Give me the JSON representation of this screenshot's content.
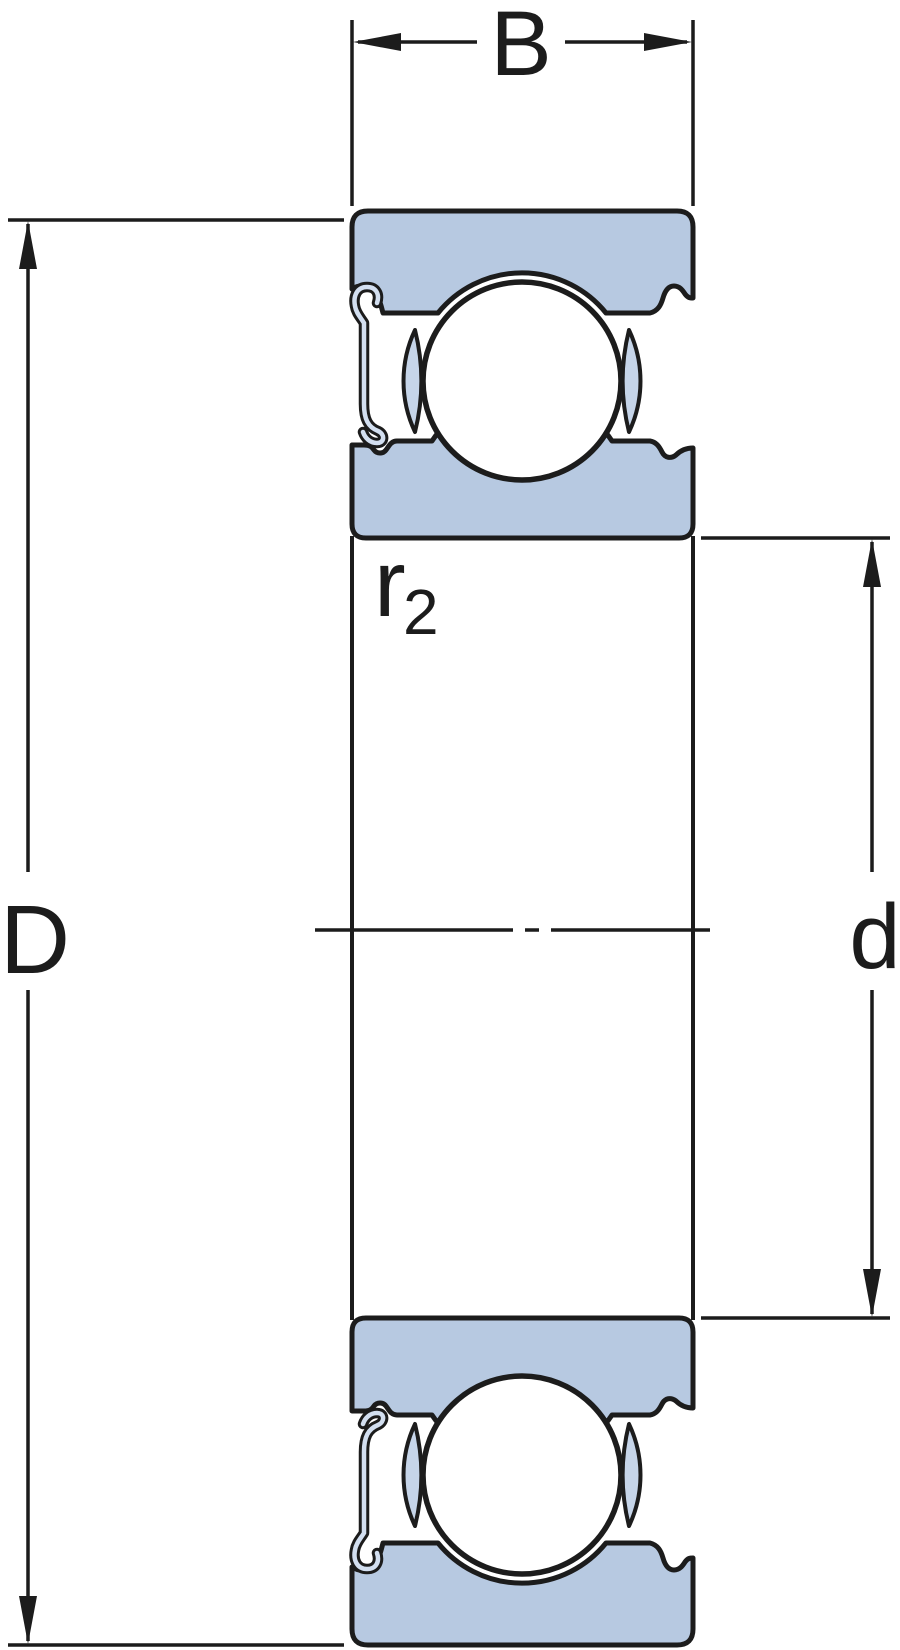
{
  "diagram": {
    "labels": {
      "width": "B",
      "outer_diameter": "D",
      "bore_diameter": "d",
      "fillet_radius": "r",
      "fillet_radius_subscript": "2"
    },
    "colors": {
      "line": "#1c1c1c",
      "ring_fill": "#b7c9e1",
      "cage_fill": "#c6d5e9",
      "shield_fill": "#d3dff0",
      "ball_fill": "#ffffff",
      "background": "#ffffff"
    }
  }
}
